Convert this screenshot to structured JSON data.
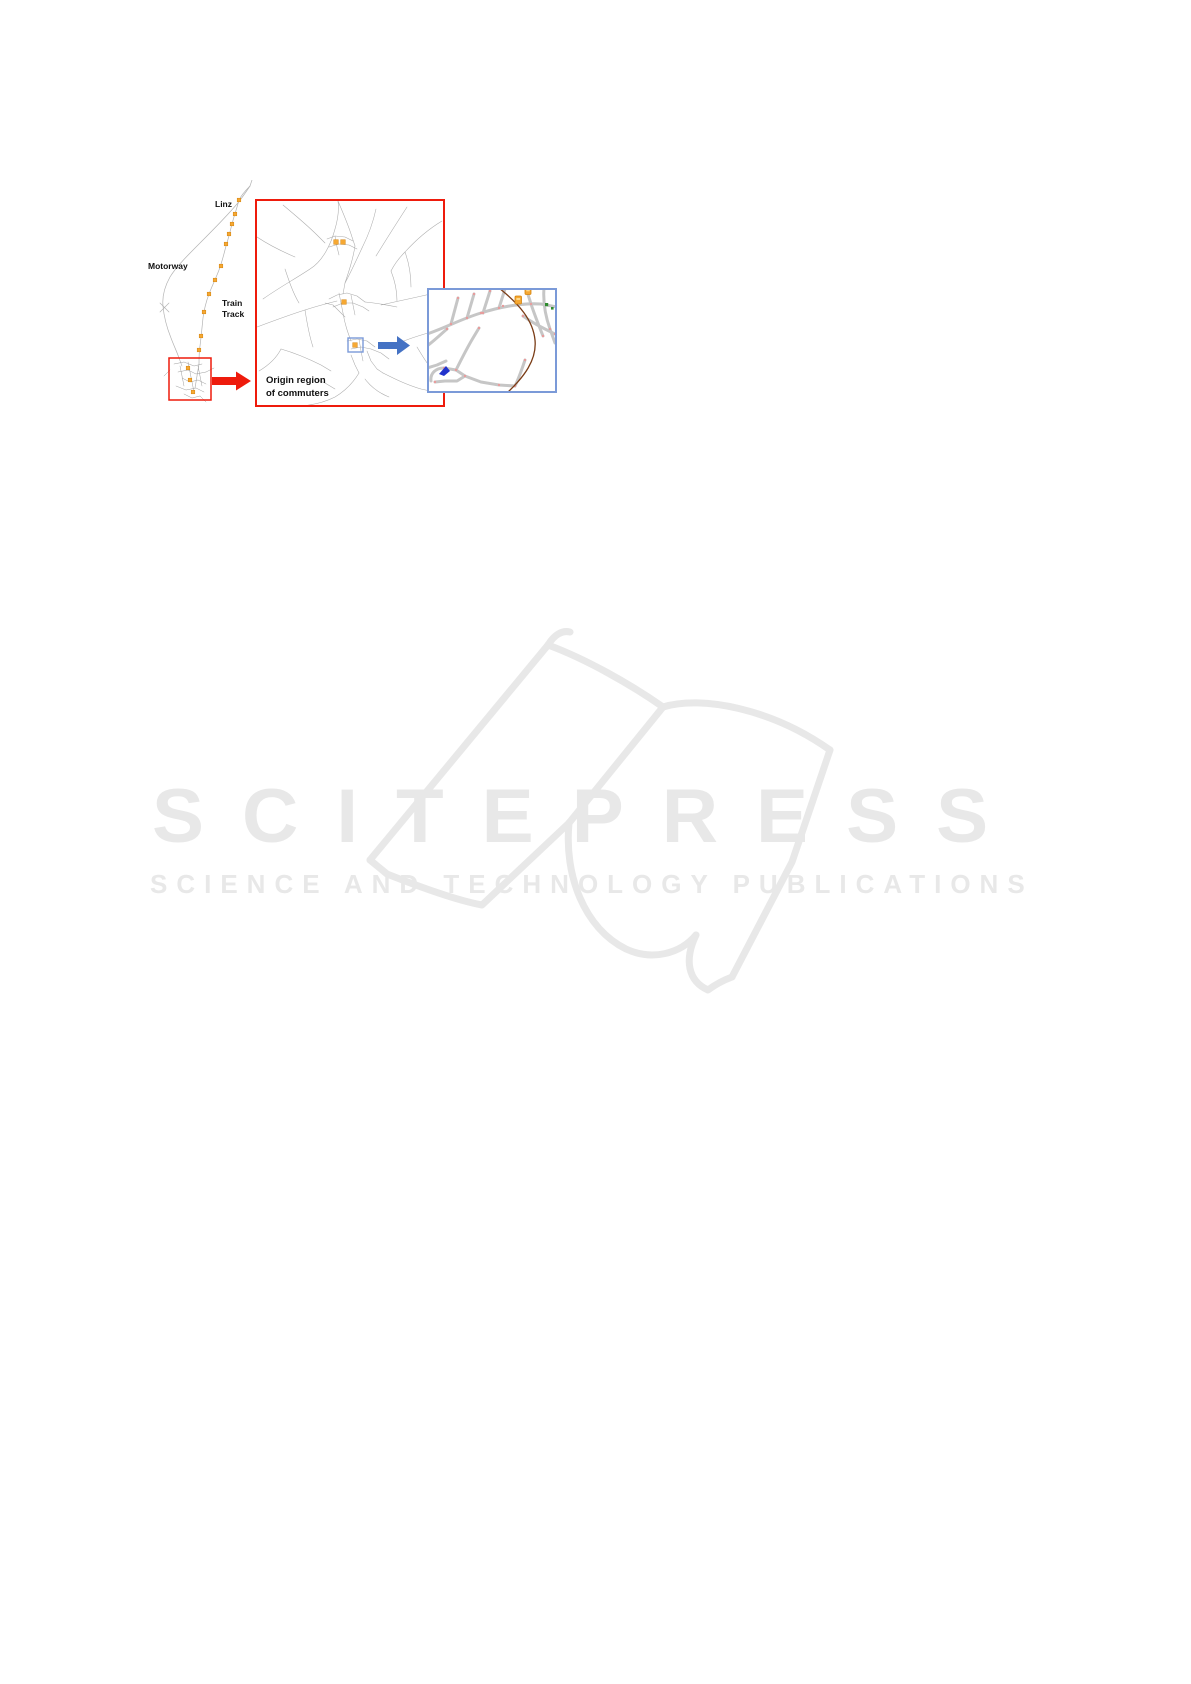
{
  "figure": {
    "minimap": {
      "city_label": "Linz",
      "motorway_label": "Motorway",
      "train_track_label_line1": "Train",
      "train_track_label_line2": "Track"
    },
    "origin_box": {
      "caption_line1": "Origin region",
      "caption_line2": "of commuters"
    },
    "legend_colors": {
      "highlight_red": "#ee1b0c",
      "detail_blue": "#7b9ad8",
      "arrow_blue": "#4472c4",
      "station_orange": "#f6a832",
      "road_gray": "#ababab",
      "rail_brown": "#7a3c16",
      "node_pink": "#e89b9b",
      "poi_green": "#2e8b2e",
      "vehicle_blue": "#2233cc"
    }
  },
  "watermark": {
    "logo_text": "SCITEPRESS",
    "tagline_text": "SCIENCE AND TECHNOLOGY PUBLICATIONS",
    "color": "#e8e8e8"
  }
}
